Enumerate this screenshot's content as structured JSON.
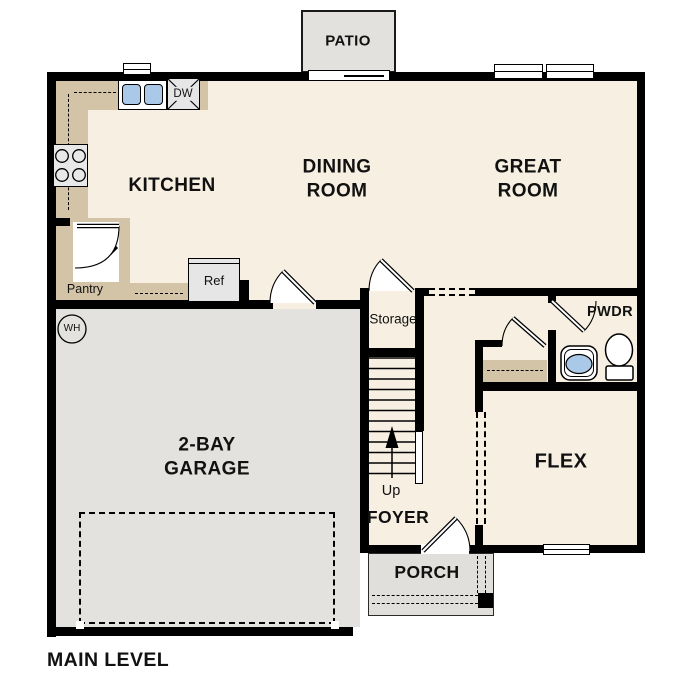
{
  "title": "MAIN LEVEL",
  "colors": {
    "floor": "#f7f0e2",
    "counter": "#d3c4a7",
    "garage_floor": "#e4e2df",
    "patio_floor": "#e3e1de",
    "wall": "#000000",
    "sink_blue": "#aac9e8",
    "fixture_gray": "#e6e6e6"
  },
  "rooms": {
    "patio": {
      "label": "PATIO"
    },
    "kitchen": {
      "label": "KITCHEN"
    },
    "dining": {
      "line1": "DINING",
      "line2": "ROOM"
    },
    "great": {
      "line1": "GREAT",
      "line2": "ROOM"
    },
    "garage": {
      "line1": "2-BAY",
      "line2": "GARAGE"
    },
    "flex": {
      "label": "FLEX"
    },
    "foyer": {
      "label": "FOYER"
    },
    "porch": {
      "label": "PORCH"
    },
    "powder": {
      "label": "PWDR"
    },
    "storage": {
      "label": "Storage"
    },
    "pantry": {
      "label": "Pantry"
    }
  },
  "fixtures": {
    "dishwasher": "DW",
    "refrigerator": "Ref",
    "water_heater": "WH",
    "stairs_direction": "Up"
  }
}
